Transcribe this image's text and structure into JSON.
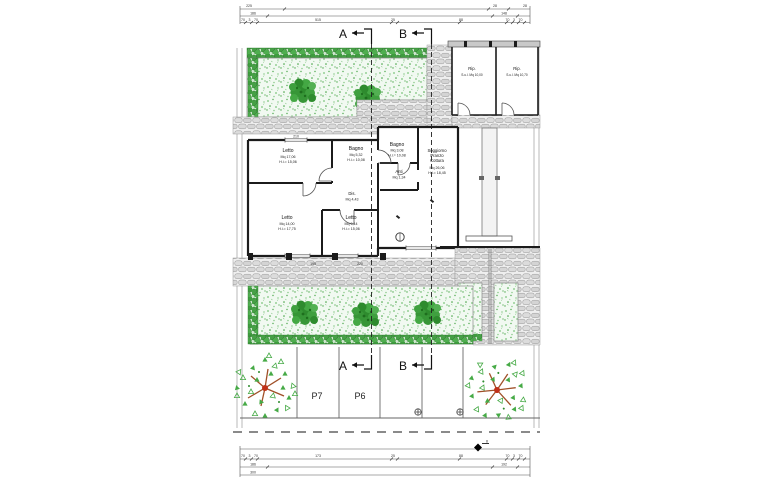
{
  "sections": {
    "a": "A",
    "b": "B"
  },
  "parking": {
    "p7": "P7",
    "p6": "P6"
  },
  "rooms": {
    "letto1": {
      "lines": [
        "Letto",
        "Mq 17,06",
        "H.i.= 15,06"
      ]
    },
    "bagno1": {
      "lines": [
        "Bagno",
        "Mq 5,32",
        "H.i.= 10,08"
      ]
    },
    "bagno2": {
      "lines": [
        "Bagno",
        "Mq 3,08",
        "H.i.= 10,08"
      ]
    },
    "anti": {
      "lines": [
        "Anti",
        "Mq 1,34"
      ]
    },
    "soggiorno": {
      "lines": [
        "Soggiorno",
        "Pranzo",
        "Cottura",
        "Mq 26,06",
        "H.i.= 18,45"
      ]
    },
    "dis": {
      "lines": [
        "Dis.",
        "Mq 4,43"
      ]
    },
    "letto2": {
      "lines": [
        "Letto",
        "Mq 14,00",
        "H.i.= 17,75"
      ]
    },
    "letto3": {
      "lines": [
        "Letto",
        "Mq 9,14",
        "H.i.= 15,06"
      ]
    },
    "rip1": {
      "lines": [
        "Rip.",
        "S.u.l. Mq 10,00"
      ]
    },
    "rip2": {
      "lines": [
        "Rip.",
        "S.u.l. Mq 10,70"
      ]
    }
  },
  "dims": {
    "top_r1": [
      "225",
      "28",
      "28"
    ],
    "top_r2": [
      "186",
      "148"
    ],
    "top_r3": [
      "70",
      "3",
      "70",
      "515",
      "25",
      "88",
      "70",
      "3",
      "70"
    ],
    "bot_r1": [
      "70",
      "3",
      "70",
      "173",
      "25",
      "88",
      "70",
      "3",
      "70"
    ],
    "bot_r2": [
      "186",
      "192"
    ],
    "bot_r3": [
      "300"
    ],
    "window_top": "210",
    "pillar_1": "195",
    "pillar_2": "220",
    "bench": "8"
  },
  "colors": {
    "wall": "#1b1b1b",
    "grass_bg": "#f1f9f1",
    "bush_green": "#2e8b2e",
    "hedge_green": "#3f9c3f",
    "stone": "#e2e2e2",
    "trunk_red": "#b04020"
  }
}
